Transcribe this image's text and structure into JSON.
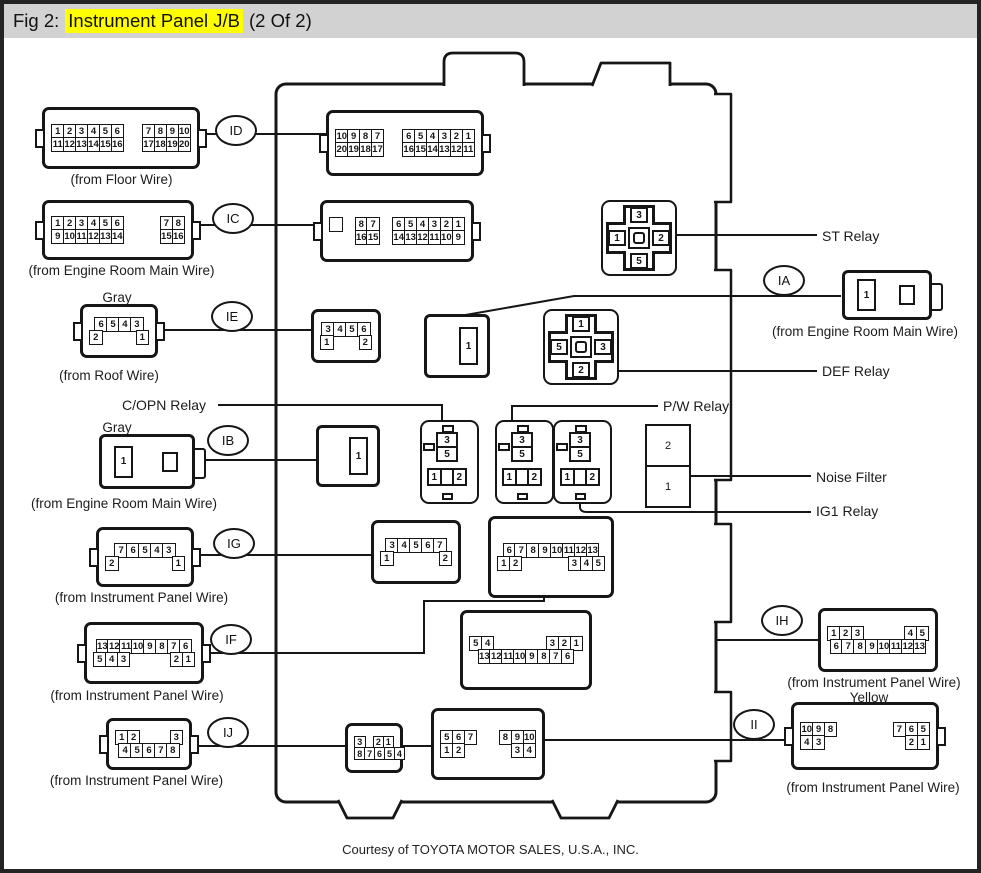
{
  "header": {
    "fig_label": "Fig 2:",
    "title_highlight": "Instrument Panel J/B",
    "title_suffix": "(2 Of 2)"
  },
  "footer": {
    "courtesy": "Courtesy of TOYOTA MOTOR SALES, U.S.A., INC."
  },
  "colors": {
    "highlight": "#ffff00",
    "header_bar": "#d2d2d2",
    "line": "#161616"
  },
  "labels": {
    "st_relay": "ST Relay",
    "def_relay": "DEF Relay",
    "pw_relay": "P/W Relay",
    "copn_relay": "C/OPN Relay",
    "noise_filter": "Noise Filter",
    "ig1_relay": "IG1 Relay",
    "gray_tag_ie": "Gray",
    "gray_tag_ib": "Gray",
    "yellow_tag_ii": "Yellow"
  },
  "relays": {
    "st": {
      "top": "3",
      "left": "1",
      "right": "2",
      "bottom": "5"
    },
    "def": {
      "top": "1",
      "left": "5",
      "right": "3",
      "bottom": "2"
    },
    "small": {
      "top": "3",
      "mid": "5",
      "left": "1",
      "right": "2"
    },
    "noise": {
      "top": "2",
      "bottom": "1"
    }
  },
  "connectors": {
    "id_ext": {
      "label": "ID",
      "caption": "(from Floor Wire)",
      "pins": [
        [
          [
            "1",
            "2",
            "3",
            "4",
            "5",
            "6"
          ],
          [
            "7",
            "8",
            "9",
            "10"
          ]
        ],
        [
          [
            "11",
            "12",
            "13",
            "14",
            "15",
            "16"
          ],
          [
            "17",
            "18",
            "19",
            "20"
          ]
        ]
      ]
    },
    "id_int": {
      "pins": [
        [
          [
            "10",
            "9",
            "8",
            "7"
          ],
          [
            "6",
            "5",
            "4",
            "3",
            "2",
            "1"
          ]
        ],
        [
          [
            "20",
            "19",
            "18",
            "17"
          ],
          [
            "16",
            "15",
            "14",
            "13",
            "12",
            "11"
          ]
        ]
      ]
    },
    "ic_ext": {
      "label": "IC",
      "caption": "(from Engine Room Main Wire)",
      "pins": [
        [
          [
            "1",
            "2",
            "3",
            "4",
            "5",
            "6"
          ],
          [
            "7",
            "8"
          ]
        ],
        [
          [
            "9",
            "10",
            "11",
            "12",
            "13",
            "14"
          ],
          [
            "15",
            "16"
          ]
        ]
      ]
    },
    "ic_int": {
      "pins": [
        [
          [
            ""
          ],
          [
            "8",
            "7"
          ],
          [
            "6",
            "5",
            "4",
            "3",
            "2",
            "1"
          ]
        ],
        [
          [
            "~"
          ],
          [
            "16",
            "15"
          ],
          [
            "14",
            "13",
            "12",
            "11",
            "10",
            "9"
          ]
        ]
      ]
    },
    "ie_ext": {
      "label": "IE",
      "caption": "(from Roof Wire)",
      "pins": [
        [
          [
            "6",
            "5",
            "4",
            "3"
          ]
        ],
        [
          [
            "2"
          ],
          [
            "1"
          ]
        ]
      ]
    },
    "ie_int": {
      "pins": [
        [
          [
            "3",
            "4",
            "5",
            "6"
          ]
        ],
        [
          [
            "1"
          ],
          [
            "2"
          ]
        ]
      ]
    },
    "single_top": {
      "pin": "1"
    },
    "ia_ext": {
      "label": "IA",
      "caption": "(from Engine Room Main Wire)",
      "pin": "1"
    },
    "ib_ext": {
      "label": "IB",
      "caption": "(from Engine  Room Main Wire)",
      "pin": "1"
    },
    "ib_int": {
      "pin": "1"
    },
    "ig_ext": {
      "label": "IG",
      "caption": "(from Instrument Panel Wire)",
      "pins": [
        [
          [
            "7",
            "6",
            "5",
            "4",
            "3"
          ]
        ],
        [
          [
            "2"
          ],
          [
            "1"
          ]
        ]
      ]
    },
    "ig_int": {
      "pins": [
        [
          [
            "3",
            "4",
            "5",
            "6",
            "7"
          ]
        ],
        [
          [
            "1"
          ],
          [
            "2"
          ]
        ]
      ]
    },
    "mid_13pin": {
      "pins": [
        [
          [
            "6",
            "7",
            "8",
            "9",
            "10",
            "11",
            "12",
            "13"
          ]
        ],
        [
          [
            "1",
            "2"
          ],
          [
            "3",
            "4",
            "5"
          ]
        ]
      ]
    },
    "if_ext": {
      "label": "IF",
      "caption": "(from Instrument Panel Wire)",
      "pins": [
        [
          [
            "13",
            "12",
            "11",
            "10",
            "9",
            "8",
            "7",
            "6"
          ]
        ],
        [
          [
            "5",
            "4",
            "3"
          ],
          [
            "2",
            "1"
          ]
        ]
      ]
    },
    "if_int": {
      "pins": [
        [
          [
            "5",
            "4"
          ],
          [
            "3",
            "2",
            "1"
          ]
        ],
        [
          [
            "13",
            "12",
            "11",
            "10",
            "9",
            "8",
            "7",
            "6"
          ]
        ]
      ]
    },
    "ih_ext": {
      "label": "IH",
      "caption": "(from Instrument Panel Wire)",
      "pins": [
        [
          [
            "1",
            "2",
            "3"
          ],
          [
            "4",
            "5"
          ]
        ],
        [
          [
            "6",
            "7",
            "8",
            "9",
            "10",
            "11",
            "12",
            "13"
          ]
        ]
      ]
    },
    "ij_ext": {
      "label": "IJ",
      "caption": "(from Instrument Panel Wire)",
      "pins": [
        [
          [
            "1",
            "2"
          ],
          [
            "3"
          ]
        ],
        [
          [
            "4",
            "5",
            "6",
            "7",
            "8"
          ]
        ]
      ]
    },
    "ij_int": {
      "pins": [
        [
          [
            "3"
          ],
          [
            "2",
            "1"
          ]
        ],
        [
          [
            "8",
            "7",
            "6",
            "5",
            "4"
          ]
        ]
      ]
    },
    "bottom_mid": {
      "pins": [
        [
          [
            "5",
            "6",
            "7"
          ],
          [
            "8",
            "9",
            "10"
          ]
        ],
        [
          [
            "1",
            "2"
          ],
          [
            "3",
            "4"
          ]
        ]
      ]
    },
    "ii_ext": {
      "label": "II",
      "caption": "(from Instrument Panel Wire)",
      "pins": [
        [
          [
            "10",
            "9",
            "8"
          ],
          [
            "7",
            "6",
            "5"
          ]
        ],
        [
          [
            "4",
            "3"
          ],
          [
            "2",
            "1"
          ]
        ]
      ]
    }
  }
}
